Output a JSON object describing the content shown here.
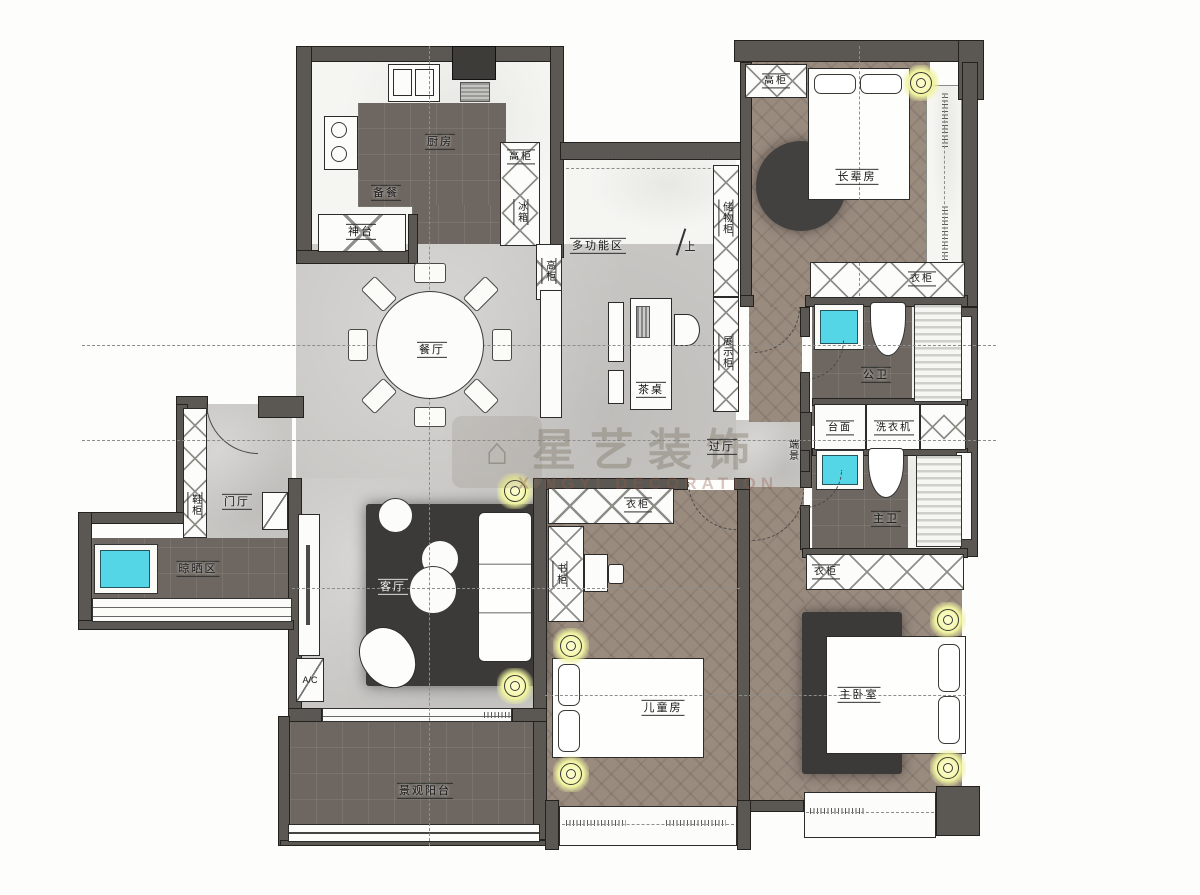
{
  "watermark": {
    "title": "星艺装饰",
    "subtitle": "XINGYI DECORATION",
    "logo": "house-emblem"
  },
  "labels": {
    "kitchen": "厨房",
    "prep": "备餐",
    "altar": "神台",
    "kitchen_tall_cabinet": "高柜",
    "fridge": "冰箱",
    "dining_tall_cabinet": "高柜",
    "multifunction": "多功能区",
    "up": "上",
    "storage_cabinet": "储物柜",
    "display_cabinet": "展示柜",
    "tea_table": "茶桌",
    "dining": "餐厅",
    "elder_tall_cabinet": "高柜",
    "elder_room": "长辈房",
    "elder_wardrobe": "衣柜",
    "public_bath": "公卫",
    "counter": "台面",
    "washer": "洗衣机",
    "end_view": "端景",
    "master_bath": "主卫",
    "hallway": "过厅",
    "shoe_cabinet": "鞋柜",
    "foyer": "门厅",
    "drying_area": "晾晒区",
    "living": "客厅",
    "ac": "A/C",
    "bookcase": "书柜",
    "kids_wardrobe": "衣柜",
    "kids_room": "儿童房",
    "master_wardrobe": "衣柜",
    "master_room": "主卧室",
    "balcony": "景观阳台"
  },
  "colors": {
    "wall": "#5b5853",
    "floor_concrete": "#c8c7c4",
    "floor_wood": "#9a8b7f",
    "floor_dark_tile": "#6e6761",
    "marble": "#f5f5f2",
    "sink_cyan": "#55d6e6",
    "light_yellow": "#f0f3a0",
    "rug_dark": "#3c3a38"
  }
}
